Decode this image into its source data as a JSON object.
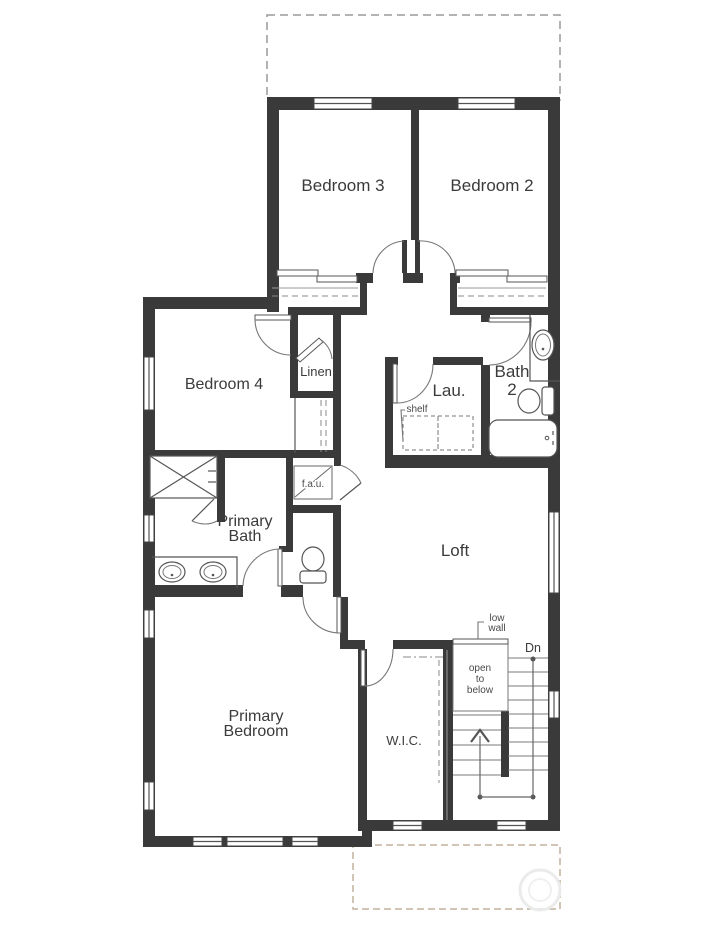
{
  "rooms": {
    "bedroom3": "Bedroom 3",
    "bedroom2": "Bedroom 2",
    "bedroom4": "Bedroom 4",
    "linen": "Linen",
    "laundry": "Lau.",
    "bath2_line1": "Bath",
    "bath2_line2": "2",
    "fau": "f.a.u.",
    "primary_bath_line1": "Primary",
    "primary_bath_line2": "Bath",
    "loft": "Loft",
    "primary_bedroom_line1": "Primary",
    "primary_bedroom_line2": "Bedroom",
    "wic": "W.I.C."
  },
  "annotations": {
    "shelf": "shelf",
    "low_wall_line1": "low",
    "low_wall_line2": "wall",
    "down": "Dn",
    "open_to_below_line1": "open",
    "open_to_below_line2": "to",
    "open_to_below_line3": "below"
  },
  "colors": {
    "wall": "#3a3a3a",
    "line": "#555555",
    "roof_outline_top": "#9a9a9a",
    "roof_outline_bottom": "#c2b39e",
    "text": "#3b3b3b",
    "background": "#ffffff"
  }
}
